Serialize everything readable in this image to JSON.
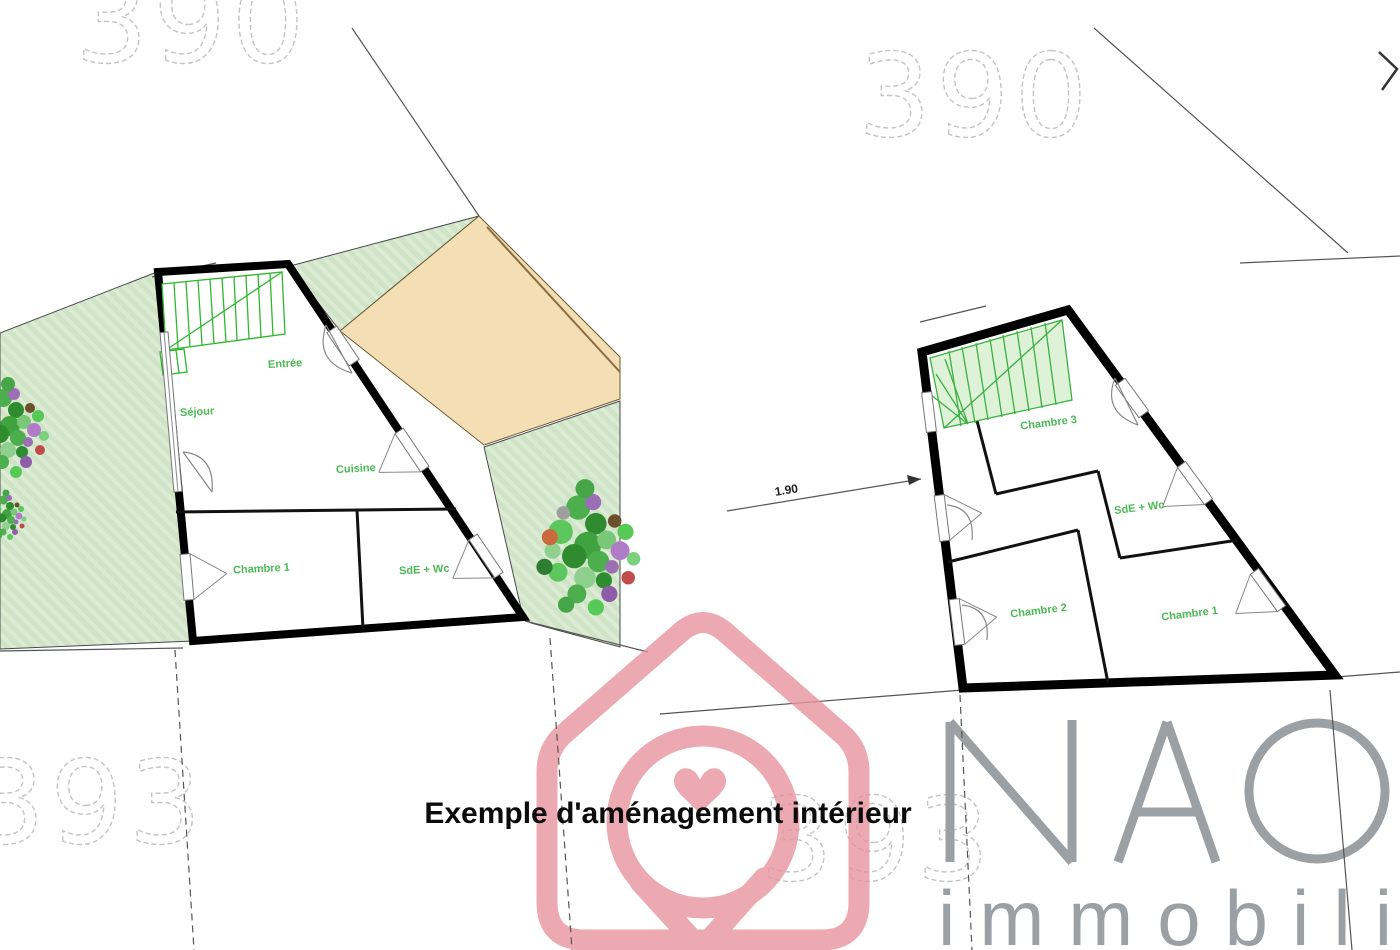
{
  "title": "Exemple d'aménagement intérieur",
  "brand": {
    "name": "NAO",
    "tagline": "immobili",
    "logo_color": "#e8949e",
    "text_color": "#9aa0a3"
  },
  "parcels": {
    "top_left": "390",
    "top_right": "390",
    "bottom_left": "393",
    "bottom_center": "393"
  },
  "ground_floor": {
    "rooms": {
      "entree": "Entrée",
      "sejour": "Séjour",
      "cuisine": "Cuisine",
      "chambre1": "Chambre 1",
      "sde_wc": "SdE + Wc"
    }
  },
  "upper_floor": {
    "rooms": {
      "chambre3": "Chambre 3",
      "sde_wc": "SdE + Wc",
      "chambre2": "Chambre 2",
      "chambre1": "Chambre 1"
    },
    "dimension_label": "1.90"
  },
  "colors": {
    "garden_green": "#cfe3c7",
    "garden_stripe": "#dcebd4",
    "terrace_tan": "#f4dfb4",
    "stair_green": "#2eb82e",
    "label_green": "#4bb954",
    "wall_black": "#000000",
    "logo_pink": "#e8949e",
    "brand_gray": "#9aa0a3",
    "parcel_outline": "#c4c4c4"
  }
}
